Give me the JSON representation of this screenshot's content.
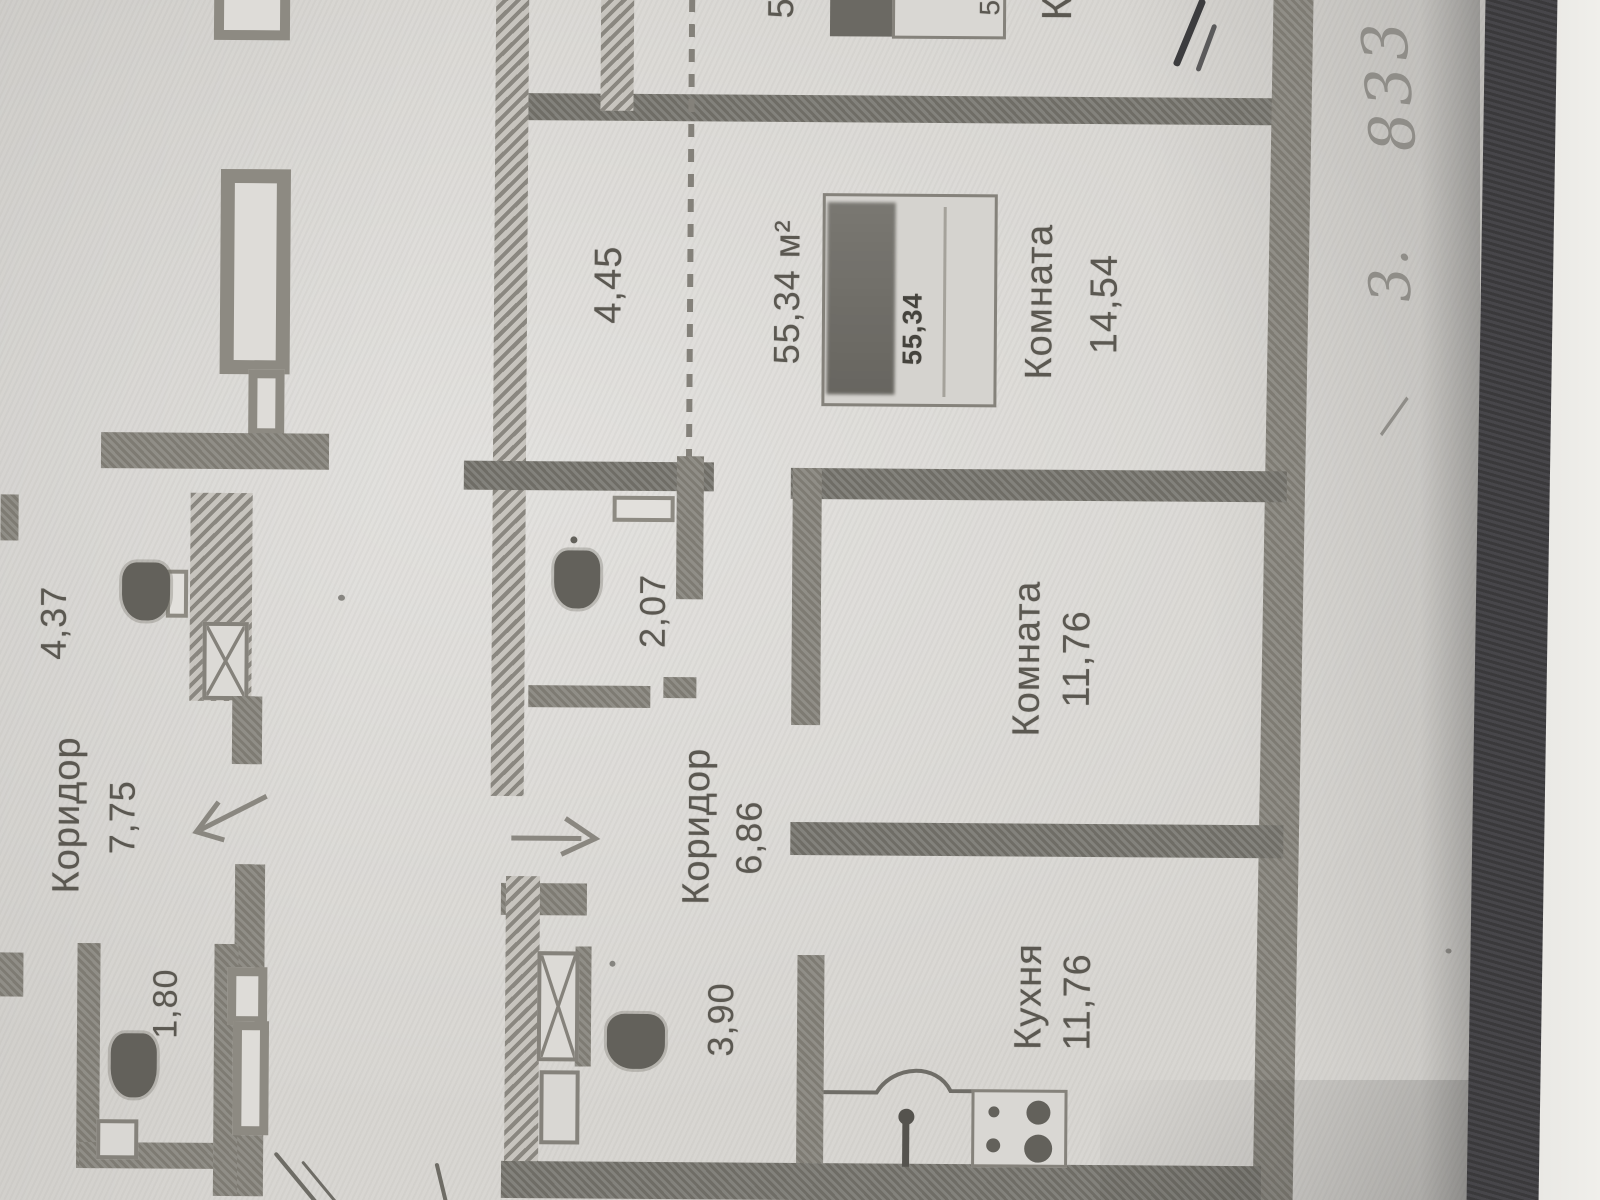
{
  "left_apartment": {
    "corridor_label": "Коридор",
    "corridor_length": "4,37",
    "corridor_area": "7,75",
    "wc_area": "1,80"
  },
  "apartment": {
    "hall_length": "4,45",
    "wc_area": "2,07",
    "corridor_label": "Коридор",
    "corridor_area": "6,86",
    "bathroom_area": "3,90",
    "total_area": "55,34 м²",
    "stamp_area": "55,34",
    "room_large_label": "Комната",
    "room_large_area": "14,54",
    "room_mid_label": "Комната",
    "room_mid_area": "11,76",
    "kitchen_label": "Кухня",
    "kitchen_area": "11,76"
  },
  "edge_cut_text": {
    "number_a": "5",
    "number_b": "5",
    "letter_k": "К"
  },
  "handwriting": {
    "number": "833",
    "prefix": "3.",
    "dash": "—"
  },
  "colors": {
    "paper": "#d8d6d2",
    "wall": "#7e7b73",
    "ink": "#5b5851",
    "fabric": "#3a393b"
  }
}
